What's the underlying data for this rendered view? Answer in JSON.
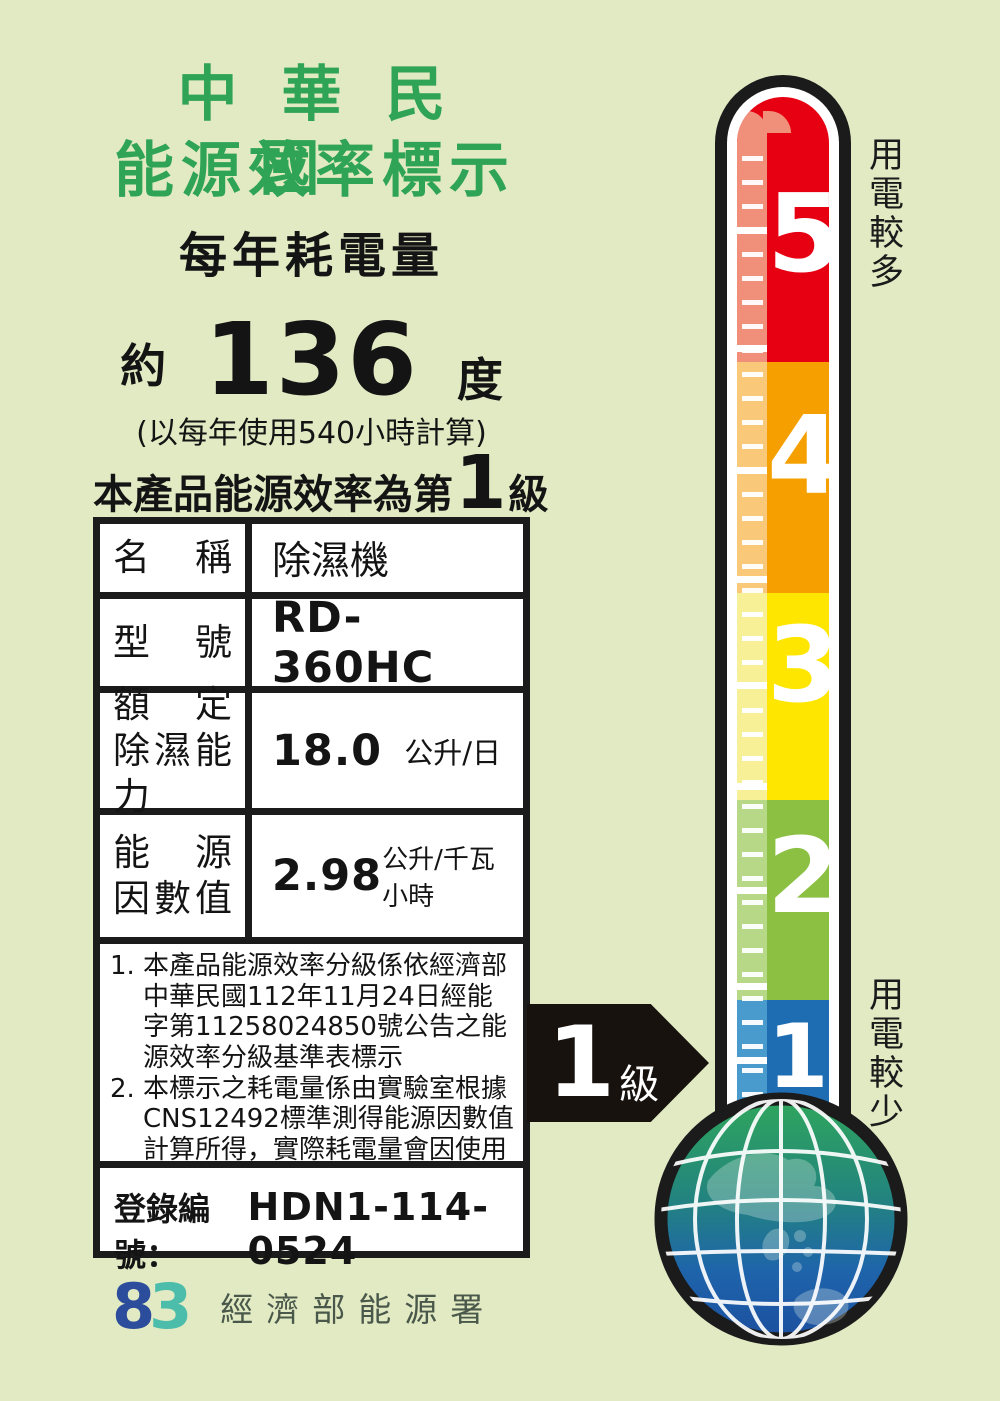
{
  "header": {
    "title_line1": "中華民國",
    "title_line2": "能源效率標示",
    "subtitle": "每年耗電量",
    "approx_prefix": "約",
    "annual_consumption": "136",
    "consumption_unit": "度",
    "calc_note": "(以每年使用540小時計算)",
    "grade_prefix": "本產品能源效率為第",
    "grade_value": "1",
    "grade_suffix": "級"
  },
  "spec_table": {
    "rows": [
      {
        "label_line1": "名　稱",
        "label_line2": "",
        "value": "除濕機",
        "unit": ""
      },
      {
        "label_line1": "型　號",
        "label_line2": "",
        "value": "RD-360HC",
        "unit": ""
      },
      {
        "label_line1": "額　定",
        "label_line2": "除濕能力",
        "value": "18.0",
        "unit": "公升/日"
      },
      {
        "label_line1": "能　源",
        "label_line2": "因數值",
        "value": "2.98",
        "unit": "公升/千瓦小時"
      }
    ]
  },
  "notes": {
    "item1_num": "1.",
    "item1_text": "本產品能源效率分級係依經濟部中華民國112年11月24日經能字第11258024850號公告之能源效率分級基準表標示",
    "item2_num": "2.",
    "item2_text": "本標示之耗電量係由實驗室根據CNS12492標準測得能源因數值計算所得，實際耗電量會因使用環境條件及使用時數而有所差異。"
  },
  "registration": {
    "label": "登錄編號：",
    "number": "HDN1-114-0524"
  },
  "footer": {
    "logo_left": "8",
    "logo_right": "3",
    "agency": "經濟部能源署"
  },
  "thermometer": {
    "label_top": "用電較多",
    "label_bottom": "用電較少",
    "levels": [
      {
        "value": "5",
        "color": "#e60012",
        "light_color": "#f0907a"
      },
      {
        "value": "4",
        "color": "#f5a000",
        "light_color": "#f9c878"
      },
      {
        "value": "3",
        "color": "#ffe600",
        "light_color": "#f8f096"
      },
      {
        "value": "2",
        "color": "#8bc043",
        "light_color": "#b7d887"
      },
      {
        "value": "1",
        "color": "#1e6db2",
        "light_color": "#4a9bcd"
      }
    ]
  },
  "grade_arrow": {
    "value": "1",
    "suffix": "級"
  },
  "colors": {
    "background": "#e2eac3",
    "title_green": "#2fa356",
    "text_black": "#141414",
    "outline_black": "#1b1b1b",
    "logo_blue": "#2b4d9b",
    "logo_teal": "#4cbcab",
    "agency_text": "#49584a",
    "globe_green": "#2fa65c",
    "globe_blue": "#1c4f9e"
  }
}
